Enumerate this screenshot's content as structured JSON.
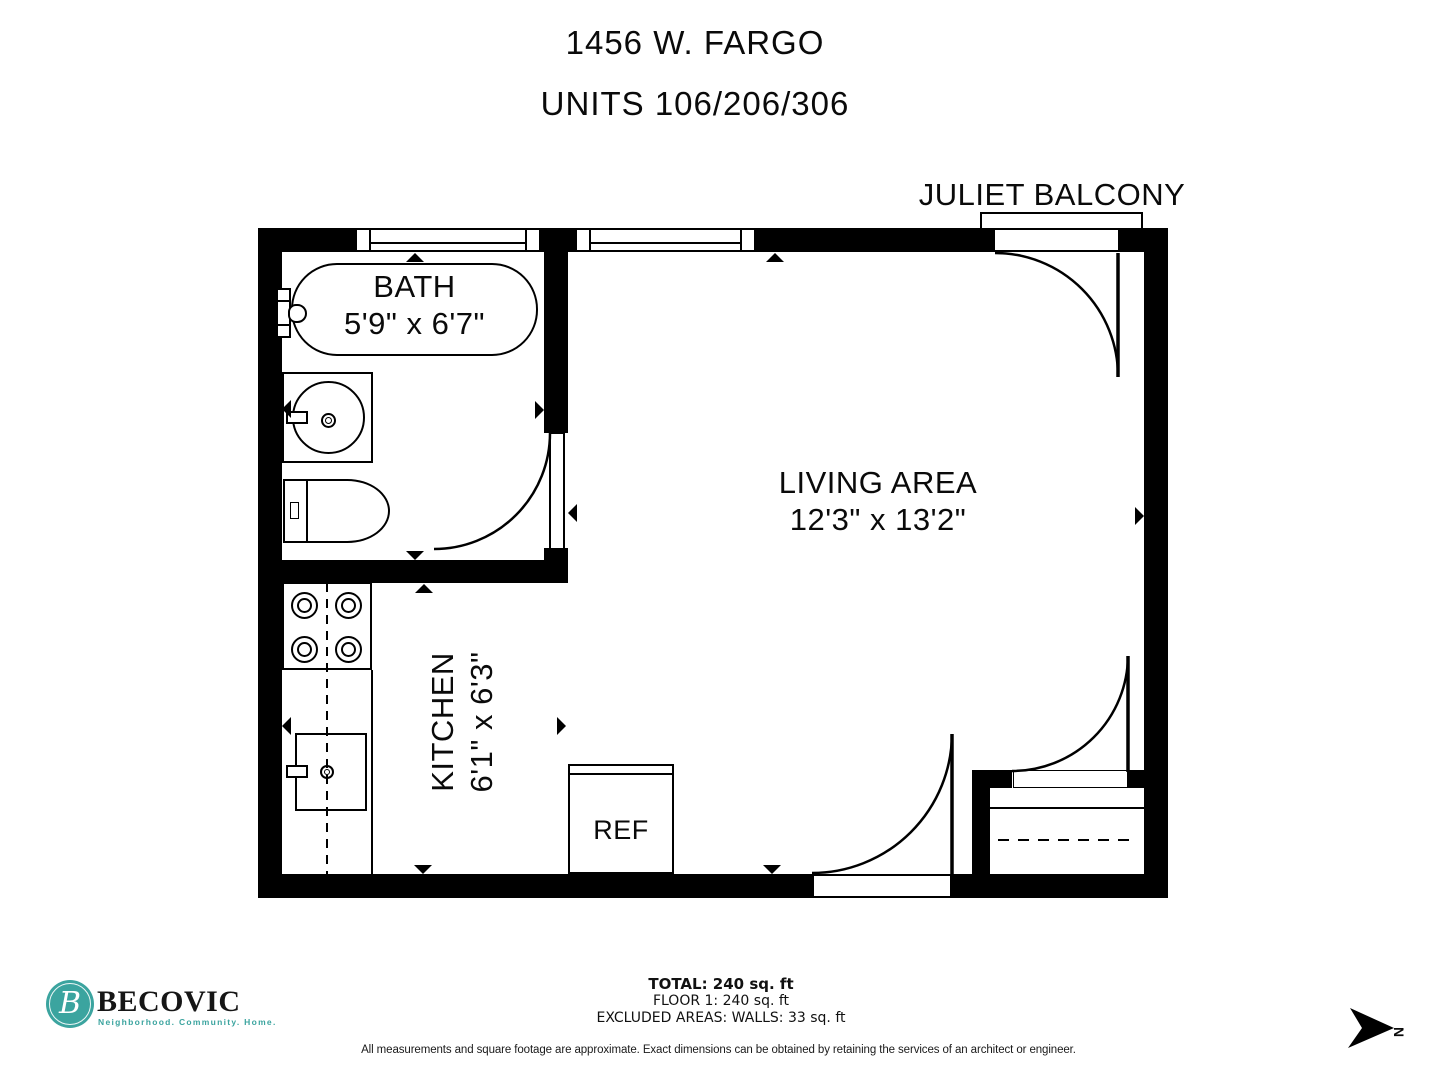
{
  "title": {
    "line1": "1456 W. FARGO",
    "line2": "UNITS 106/206/306"
  },
  "plan": {
    "balcony_label": "JULIET BALCONY",
    "bath": {
      "name": "BATH",
      "dims": "5'9\" x 6'7\""
    },
    "living": {
      "name": "LIVING AREA",
      "dims": "12'3\" x 13'2\""
    },
    "kitchen": {
      "name": "KITCHEN",
      "dims": "6'1\" x 6'3\""
    },
    "ref_label": "REF",
    "north_label": "N"
  },
  "footer": {
    "brand": {
      "monogram": "B",
      "name": "BECOVIC",
      "tagline": "Neighborhood. Community. Home.",
      "teal": "#3ba49f"
    },
    "totals": {
      "total": "TOTAL: 240 sq. ft",
      "floor": "FLOOR 1: 240 sq. ft",
      "excluded": "EXCLUDED AREAS: WALLS: 33 sq. ft"
    },
    "disclaimer": "All measurements and square footage are approximate. Exact dimensions can be obtained by retaining the services of an architect or engineer."
  },
  "colors": {
    "ink": "#000000",
    "accent_teal": "#3ba49f"
  }
}
